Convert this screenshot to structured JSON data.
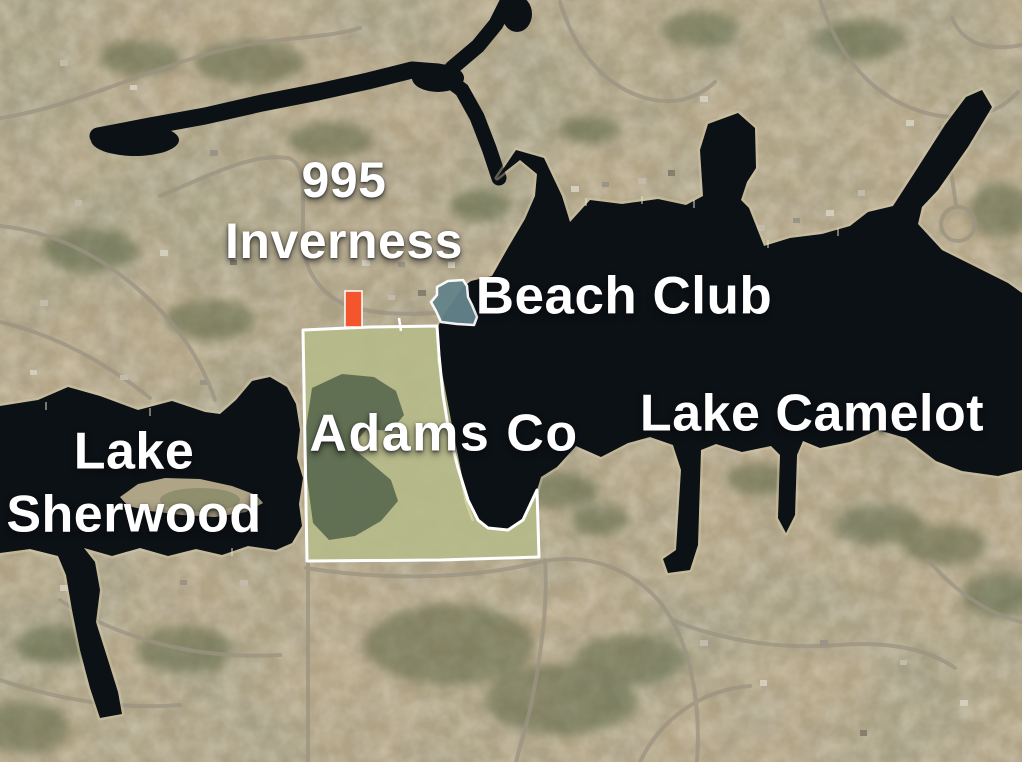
{
  "map": {
    "labels": {
      "address_line1": "995",
      "address_line2": "Inverness",
      "beach_club": "Beach Club",
      "lake_camelot": "Lake Camelot",
      "adams_co": "Adams Co",
      "lake_sherwood_line1": "Lake",
      "lake_sherwood_line2": "Sherwood"
    },
    "colors": {
      "label_text": "#ffffff",
      "water": "#0c1115",
      "land_base": "#b3a486",
      "parcel_outline": "#ffffff",
      "parcel_field": "#b6ba88",
      "parcel_marsh": "#52614a",
      "beach_club_fill": "#64838a",
      "marker_orange": "#f4552d"
    }
  }
}
